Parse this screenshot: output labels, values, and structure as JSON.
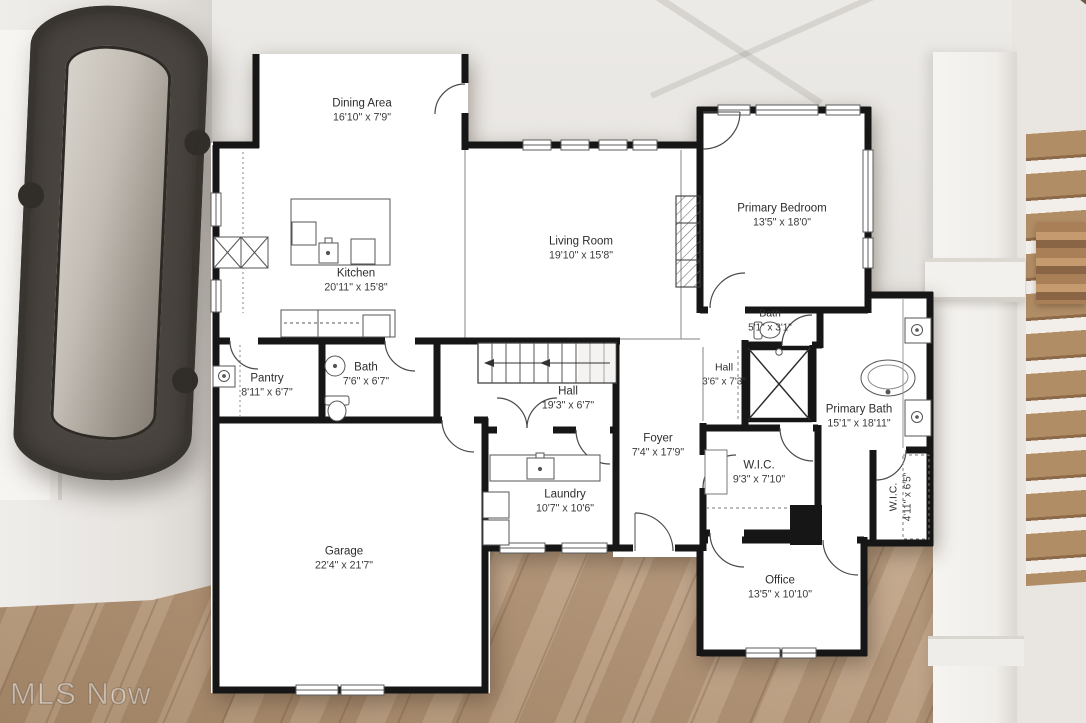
{
  "watermark": "MLS Now",
  "rooms": [
    {
      "name": "Dining Area",
      "dims": "16'10\" x 7'9\""
    },
    {
      "name": "Kitchen",
      "dims": "20'11\" x 15'8\""
    },
    {
      "name": "Living Room",
      "dims": "19'10\" x 15'8\""
    },
    {
      "name": "Primary Bedroom",
      "dims": "13'5\" x 18'0\""
    },
    {
      "name": "Bath",
      "dims": "5'1\" x 3'1\""
    },
    {
      "name": "Pantry",
      "dims": "8'11\" x 6'7\""
    },
    {
      "name": "Bath",
      "dims": "7'6\" x 6'7\""
    },
    {
      "name": "Hall",
      "dims": "19'3\" x 6'7\""
    },
    {
      "name": "Hall",
      "dims": "3'6\" x 7'3\""
    },
    {
      "name": "Foyer",
      "dims": "7'4\" x 17'9\""
    },
    {
      "name": "Laundry",
      "dims": "10'7\" x 10'6\""
    },
    {
      "name": "Garage",
      "dims": "22'4\" x 21'7\""
    },
    {
      "name": "W.I.C.",
      "dims": "9'3\" x 7'10\""
    },
    {
      "name": "Primary Bath",
      "dims": "15'1\" x 18'11\""
    },
    {
      "name": "W.I.C.",
      "dims": "4'11\" x 6'5\""
    },
    {
      "name": "Office",
      "dims": "13'5\" x 10'10\""
    }
  ],
  "colors": {
    "wall": "#161616",
    "plan_background": "#ffffff",
    "floor_wood": "#c1a283",
    "label_text": "#2d2d2d"
  }
}
